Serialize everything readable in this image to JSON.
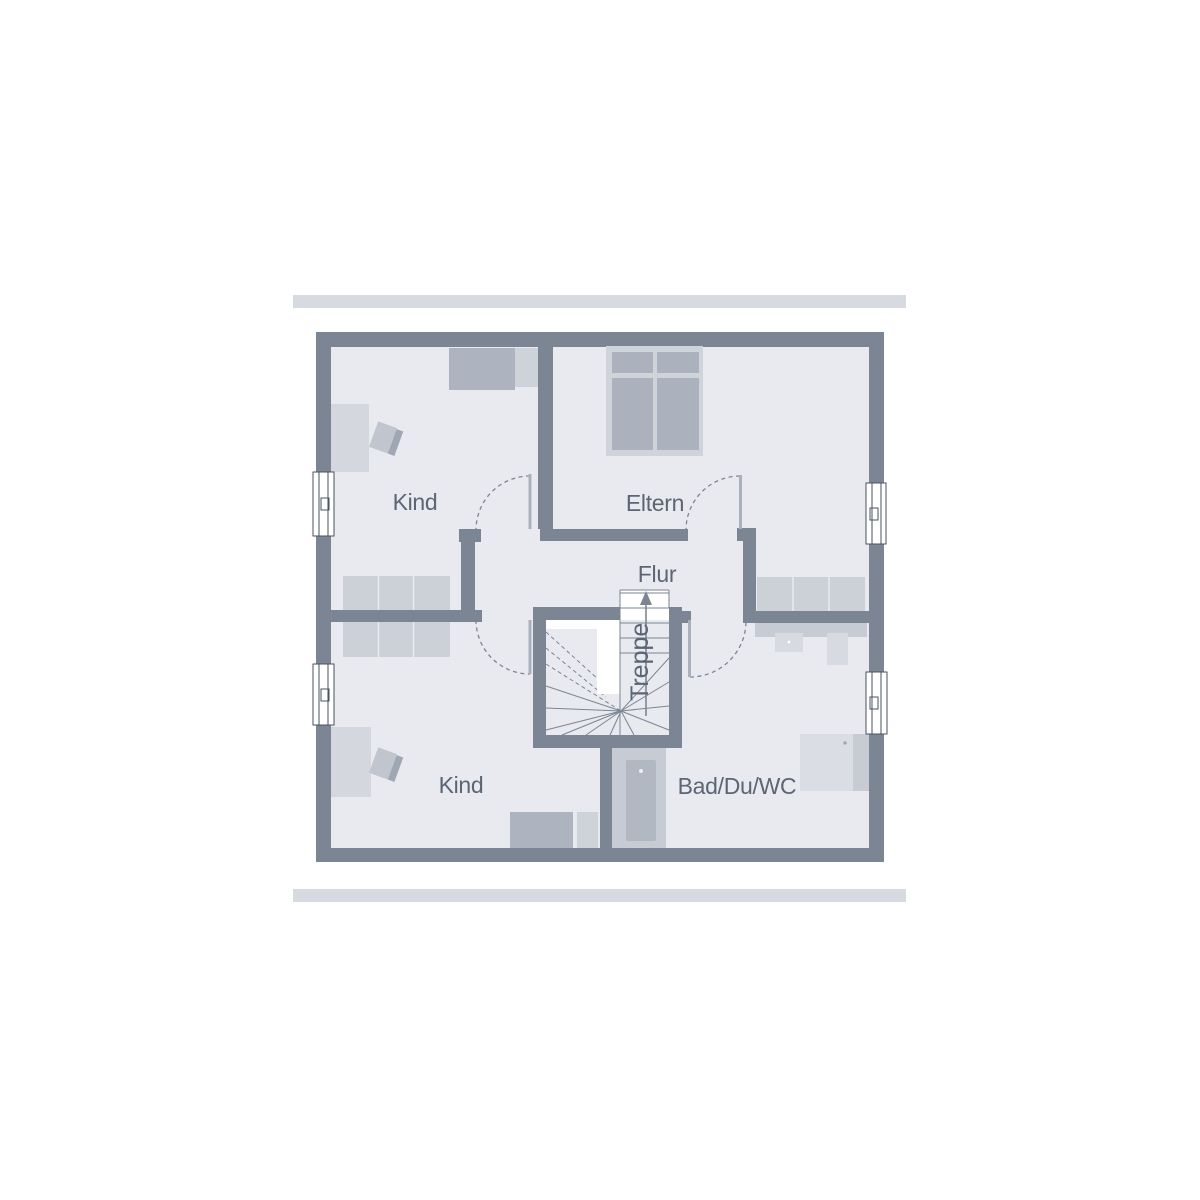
{
  "decor": {
    "top_bar": "accent-bar",
    "bottom_bar": "accent-bar"
  },
  "floorplan": {
    "rooms": {
      "kind_top": "Kind",
      "eltern": "Eltern",
      "flur": "Flur",
      "kind_bottom": "Kind",
      "bad": "Bad/Du/WC"
    },
    "stairs": {
      "label": "Treppe",
      "direction": "up"
    },
    "colors": {
      "wall": "#7b8593",
      "floor": "#e9eaef",
      "accent_bar": "#d8dae1",
      "label_text": "#5c6574",
      "furniture_light": "#d4d7de",
      "furniture_medium": "#c7ccd4",
      "furniture_dark": "#aeb4bf",
      "bed_frame": "#cfd3da",
      "window_frame": "#4a5361",
      "door_leaf": "#aab1bc"
    }
  }
}
